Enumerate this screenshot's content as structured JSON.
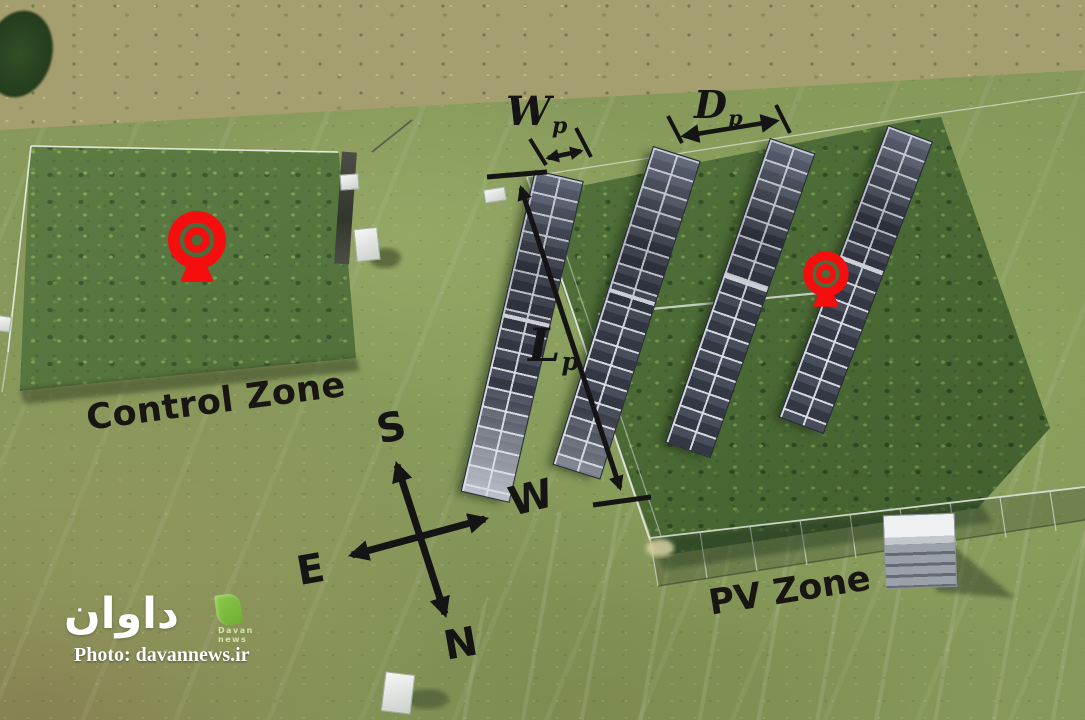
{
  "zones": {
    "control": {
      "label": "Control Zone"
    },
    "pv": {
      "label": "PV Zone"
    }
  },
  "dimensions": {
    "panel_width": {
      "symbol": "W",
      "sub": "p"
    },
    "row_spacing": {
      "symbol": "D",
      "sub": "p"
    },
    "row_length": {
      "symbol": "L",
      "sub": "p"
    }
  },
  "compass": {
    "up": "S",
    "right": "W",
    "left": "E",
    "down": "N"
  },
  "watermark": {
    "logo_text": "داوان",
    "logo_caption_line1": "Davan",
    "logo_caption_line2": "news",
    "credit": "Photo: davannews.ir"
  },
  "colors": {
    "camera_marker": "#F60D0D",
    "annotation": "#141414",
    "pv_panel": "#3D4251",
    "logo_green": "#7DBF3F",
    "grass": "#86995A"
  }
}
